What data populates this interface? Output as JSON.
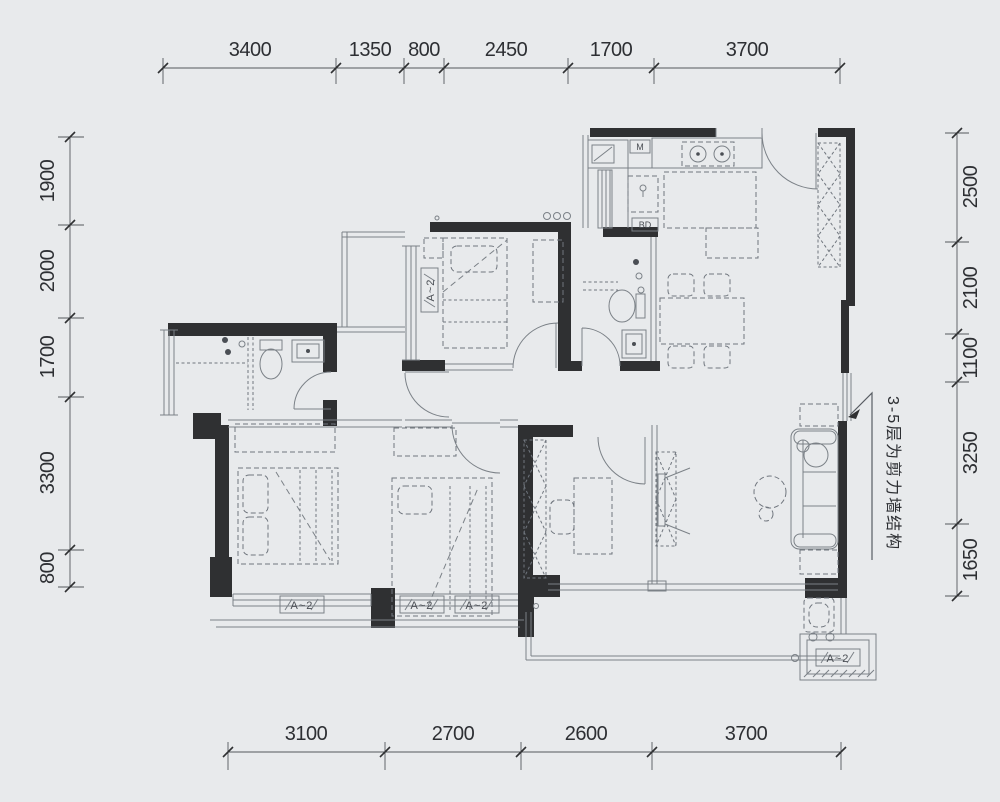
{
  "dims": {
    "top": [
      "3400",
      "1350",
      "800",
      "2450",
      "1700",
      "3700"
    ],
    "left": [
      "1900",
      "2000",
      "1700",
      "3300",
      "800"
    ],
    "right": [
      "2500",
      "2100",
      "1100",
      "3250",
      "1650"
    ],
    "bottom": [
      "3100",
      "2700",
      "2600",
      "3700"
    ]
  },
  "annotation": {
    "wall_note": "3-5层为剪力墙结构"
  },
  "kitchen": {
    "microwave_label": "M",
    "appliance_label": "BD"
  },
  "window_tags": {
    "bedroom2_side": "A~2",
    "master_bottom": "A~2",
    "bedroom3_left": "A~2",
    "bedroom3_right": "A~2",
    "balcony": "A~2"
  },
  "colors": {
    "background": "#e8eaec",
    "wall": "#2f3032",
    "line": "#7b8187",
    "dim_text": "#2d2f33"
  }
}
